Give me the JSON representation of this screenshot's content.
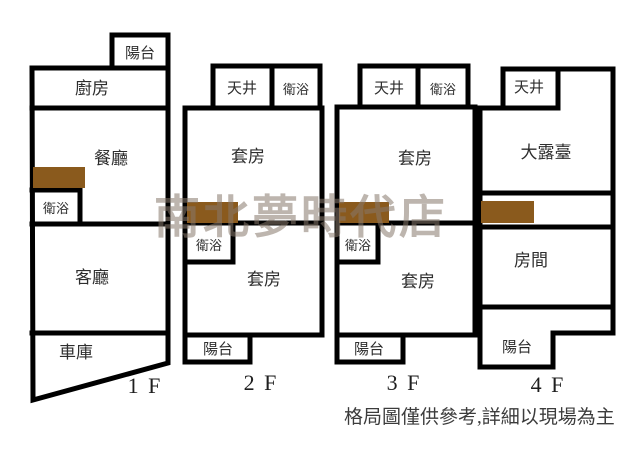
{
  "diagram_title": "",
  "watermark": "南北夢時代店",
  "note": "格局圖僅供參考,詳細以現場為主",
  "colors": {
    "wall": "#000000",
    "stairs_marker": "#8a5a1d",
    "watermark_gray": "rgba(135,120,108,0.55)",
    "note_text": "#3c3c3c",
    "background": "#ffffff"
  },
  "floors": [
    {
      "label": "1 F",
      "rooms": {
        "balcony": "陽台",
        "kitchen": "廚房",
        "dining": "餐廳",
        "bath": "衛浴",
        "living": "客廳",
        "garage": "車庫"
      }
    },
    {
      "label": "2 F",
      "rooms": {
        "atrium": "天井",
        "bath_top": "衛浴",
        "suite_upper": "套房",
        "bath_mid": "衛浴",
        "suite_lower": "套房",
        "balcony": "陽台"
      }
    },
    {
      "label": "3 F",
      "rooms": {
        "atrium": "天井",
        "bath_top": "衛浴",
        "suite_upper": "套房",
        "bath_mid": "衛浴",
        "suite_lower": "套房",
        "balcony": "陽台"
      }
    },
    {
      "label": "4 F",
      "rooms": {
        "atrium": "天井",
        "terrace": "大露臺",
        "room": "房間",
        "balcony": "陽台"
      }
    }
  ]
}
